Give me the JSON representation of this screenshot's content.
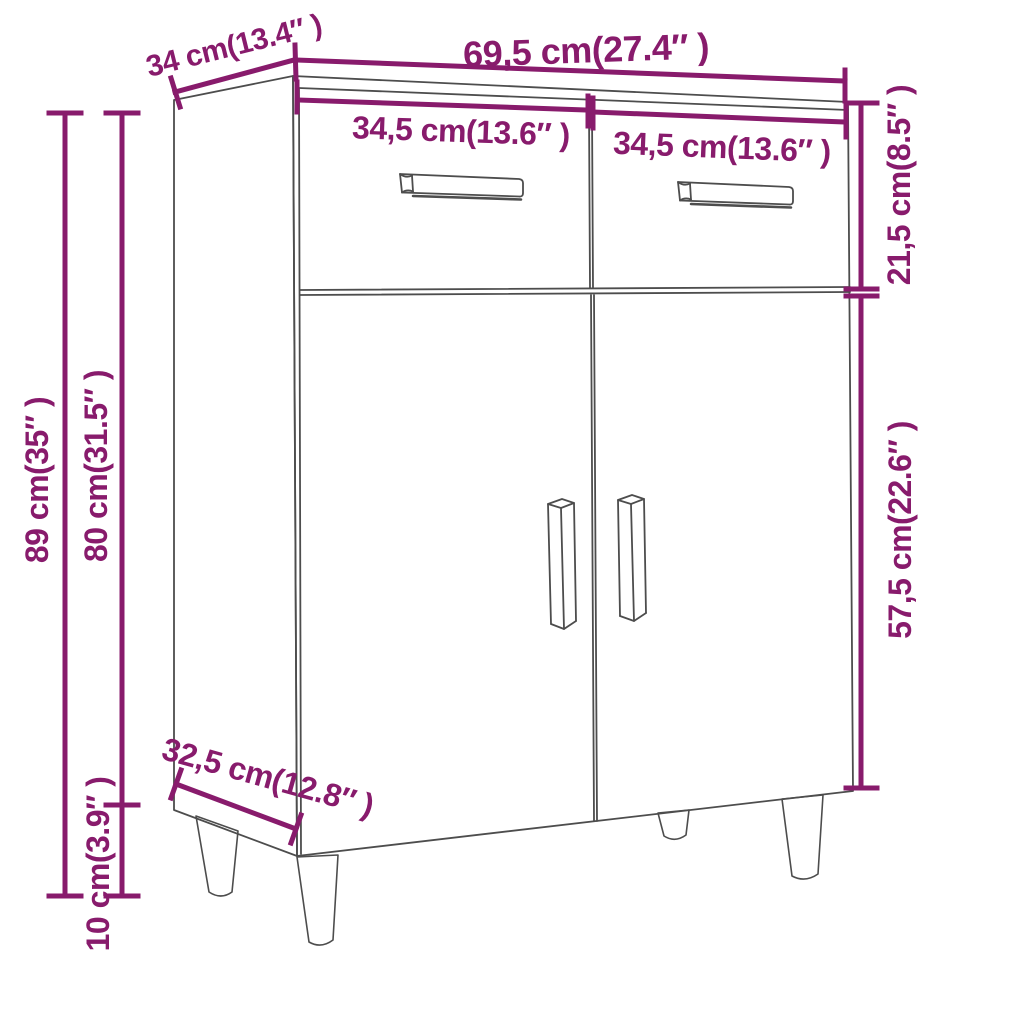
{
  "colors": {
    "accent": "#881b6c",
    "line": "#4d4d4d",
    "background": "#ffffff"
  },
  "diagram": {
    "subject": "sideboard-with-2-drawers-2-doors-dimension-drawing"
  },
  "dimensions": {
    "overall_width": "69,5 cm(27.4″ )",
    "top_depth": "34 cm(13.4″ )",
    "left_drawer_width": "34,5 cm(13.6″ )",
    "right_drawer_width": "34,5 cm(13.6″ )",
    "drawer_section_height": "21,5 cm(8.5″ )",
    "door_section_height": "57,5 cm(22.6″ )",
    "overall_height": "89 cm(35″ )",
    "body_height": "80 cm(31.5″ )",
    "leg_height": "10 cm(3.9″ )",
    "bottom_depth": "32,5 cm(12.8″ )"
  }
}
